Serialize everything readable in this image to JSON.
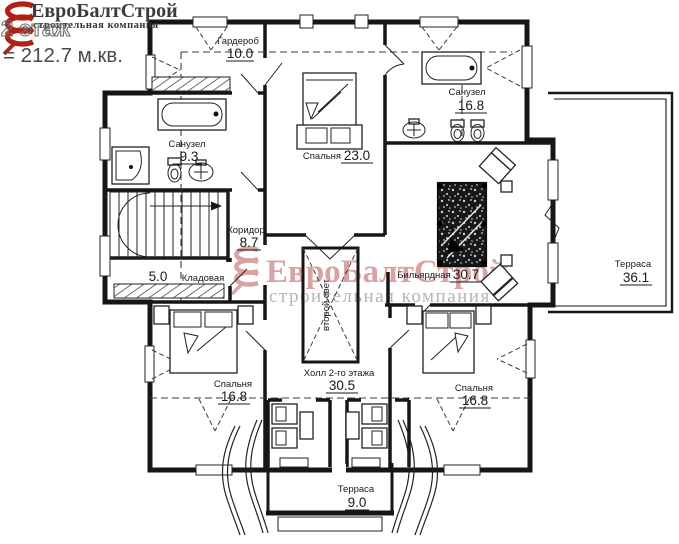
{
  "header": {
    "brand": "ЕвроБалтСтрой",
    "brand_subtitle": "строительная компания",
    "floor_label": "2 этаж",
    "total_area": "= 212.7 м.кв."
  },
  "watermark": {
    "brand": "ЕвроБалтСтрой",
    "subtitle": "строительная компания"
  },
  "rooms": [
    {
      "name": "Гардероб",
      "area": "10.0"
    },
    {
      "name": "Спальня",
      "area": "23.0"
    },
    {
      "name": "Санузел",
      "area": "16.8"
    },
    {
      "name": "Санузел",
      "area": "9.3"
    },
    {
      "name": "Коридор",
      "area": "8.7"
    },
    {
      "name": "Кладовая",
      "area": "5.0"
    },
    {
      "name": "Бильярдная",
      "area": "30.7"
    },
    {
      "name": "Терраса",
      "area": "36.1"
    },
    {
      "name": "Спальня",
      "area": "16.8"
    },
    {
      "name": "Холл 2-го этажа",
      "area": "30.5"
    },
    {
      "name": "Спальня",
      "area": "16.8"
    },
    {
      "name": "Терраса",
      "area": "9.0"
    }
  ],
  "annotations": {
    "void_label": "второй свет"
  },
  "colors": {
    "brand_red": "#b02015",
    "watermark_red": "#d9a3a3",
    "watermark_gray": "#b5b5ba",
    "wall": "#161616",
    "label_text": "#1a1a1a"
  }
}
